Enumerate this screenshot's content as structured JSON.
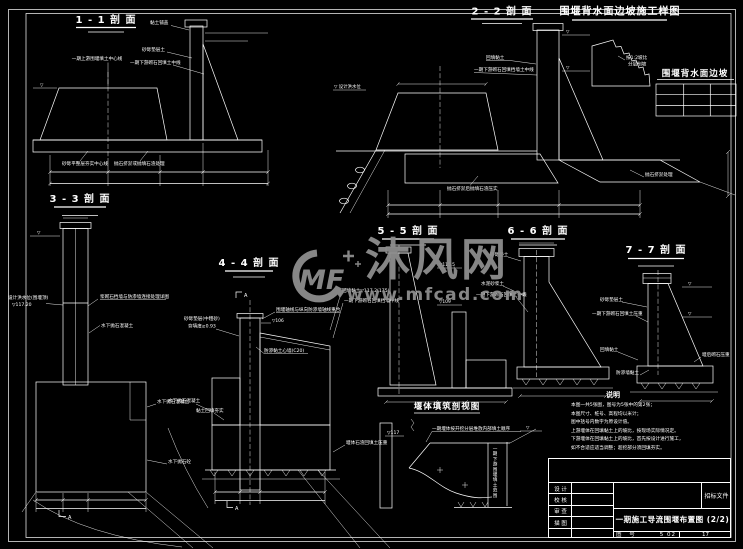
{
  "colors": {
    "background": "#000000",
    "line": "#ffffff",
    "watermark": "#8e8e8e"
  },
  "sections": {
    "s11": {
      "title": "1 - 1 剖 面"
    },
    "s22": {
      "title": "2 - 2 剖 面"
    },
    "s33": {
      "title": "3 - 3 剖 面"
    },
    "s44": {
      "title": "4 - 4 剖 面"
    },
    "s55": {
      "title": "5 - 5 剖 面"
    },
    "s66": {
      "title": "6 - 6 剖 面"
    },
    "s77": {
      "title": "7 - 7 剖 面"
    },
    "slope_detail": {
      "title": "围堰背水面边坡施工样图"
    },
    "slope_table": {
      "title": "围堰背水面边坡"
    },
    "cutaway": {
      "title": "堰体填筑剖视图"
    }
  },
  "annotations": {
    "s11_center": "一期上游围堰填土中心线",
    "s11_clay": "黏土铺盖",
    "s11_sand": "砂砾垫层土",
    "s11_mid": "一期下游砌石回填土中线",
    "s11_base1": "砂砾平整层夯实中心线",
    "s11_base2": "抛石挤淤或抛填石渣处理",
    "s22_wl": "▽ 设计洪水位",
    "s22_clay": "回填黏土",
    "s22_mid": "一期下游砌石回填挡墙土中线",
    "s22_base": "抛石挤淤后抛填石渣压实",
    "s22_right": "抛石挤淤处理",
    "sd_note1": "按1:2坡比",
    "sd_note2": "分层削坡",
    "s33_wl1": "设计洪水位(围堰顶)",
    "s33_wl2": "▽117.20",
    "s33_conn": "浆砌石挡墙与防渗墙连接处理详图",
    "s33_conc": "水下抛石混凝土",
    "s33_r1": "水下抛石混凝土",
    "s33_r2": "水下抛石砼",
    "s44_l1": "砂砾垫层(中粗砂)",
    "s44_l2": "夯填度≥0.93",
    "s44_axis": "围堰轴线与纵向防渗墙轴线重合",
    "s44_el": "▽106",
    "s44_r1": "回填黏土▽117.2(175)",
    "s44_r2": "一期下游砌石回填挡墙中线",
    "s44_core": "防渗黏土心墙(C20)",
    "s44_b1": "水下抛石混凝土",
    "s44_b2": "黏土回填夯实",
    "s44_rock": "堰体石渣回填土压重",
    "s55_el1": "▽115.5",
    "s55_el2": "▽109",
    "s66_sand": "砂砾垫土",
    "s66_mortar": "水泥砂浆土",
    "s66_mid": "一期下游砌石回填土中线",
    "s77_sand": "砂砾垫层土",
    "s77_weight": "一期下游砌石回填土压重",
    "s77_clay": "回填黏土",
    "s77_core": "防渗墙黏土",
    "s77_after": "堰后砌石压重",
    "cut_note": "一期堰体按开挖分层堆放内部填土顺序",
    "cut_el": "▽117",
    "cut_range": "一期下游围堰填土范围",
    "mark_a": "A",
    "wl_glyph": "▽"
  },
  "watermark": {
    "logo": "MF",
    "brand": "沐风网",
    "url": "www.mfcad.com"
  },
  "notes": {
    "heading": "说明",
    "lines": [
      "本图一共5张图，图号为5张中的第2张；",
      "本图尺寸、桩号、高程均以米计；",
      "图中括号内数字为原设计值。",
      "上游堰体在回填黏土上的坡比，按现场实际情况定。",
      "下游堰体在回填黏土上的坡比，首先按设计进行施工，",
      "如不合适应适当调整；超挖部分须回填夯实。"
    ]
  },
  "title_block": {
    "doc_type": "招标文件",
    "roles": [
      "设 计",
      "校 核",
      "审 查",
      "描 图"
    ],
    "drawing_title": "一期施工导流围堰布置图 (2/2)",
    "fig_label": "图 号",
    "fig_no": "5 02",
    "sheet_no": "17"
  }
}
